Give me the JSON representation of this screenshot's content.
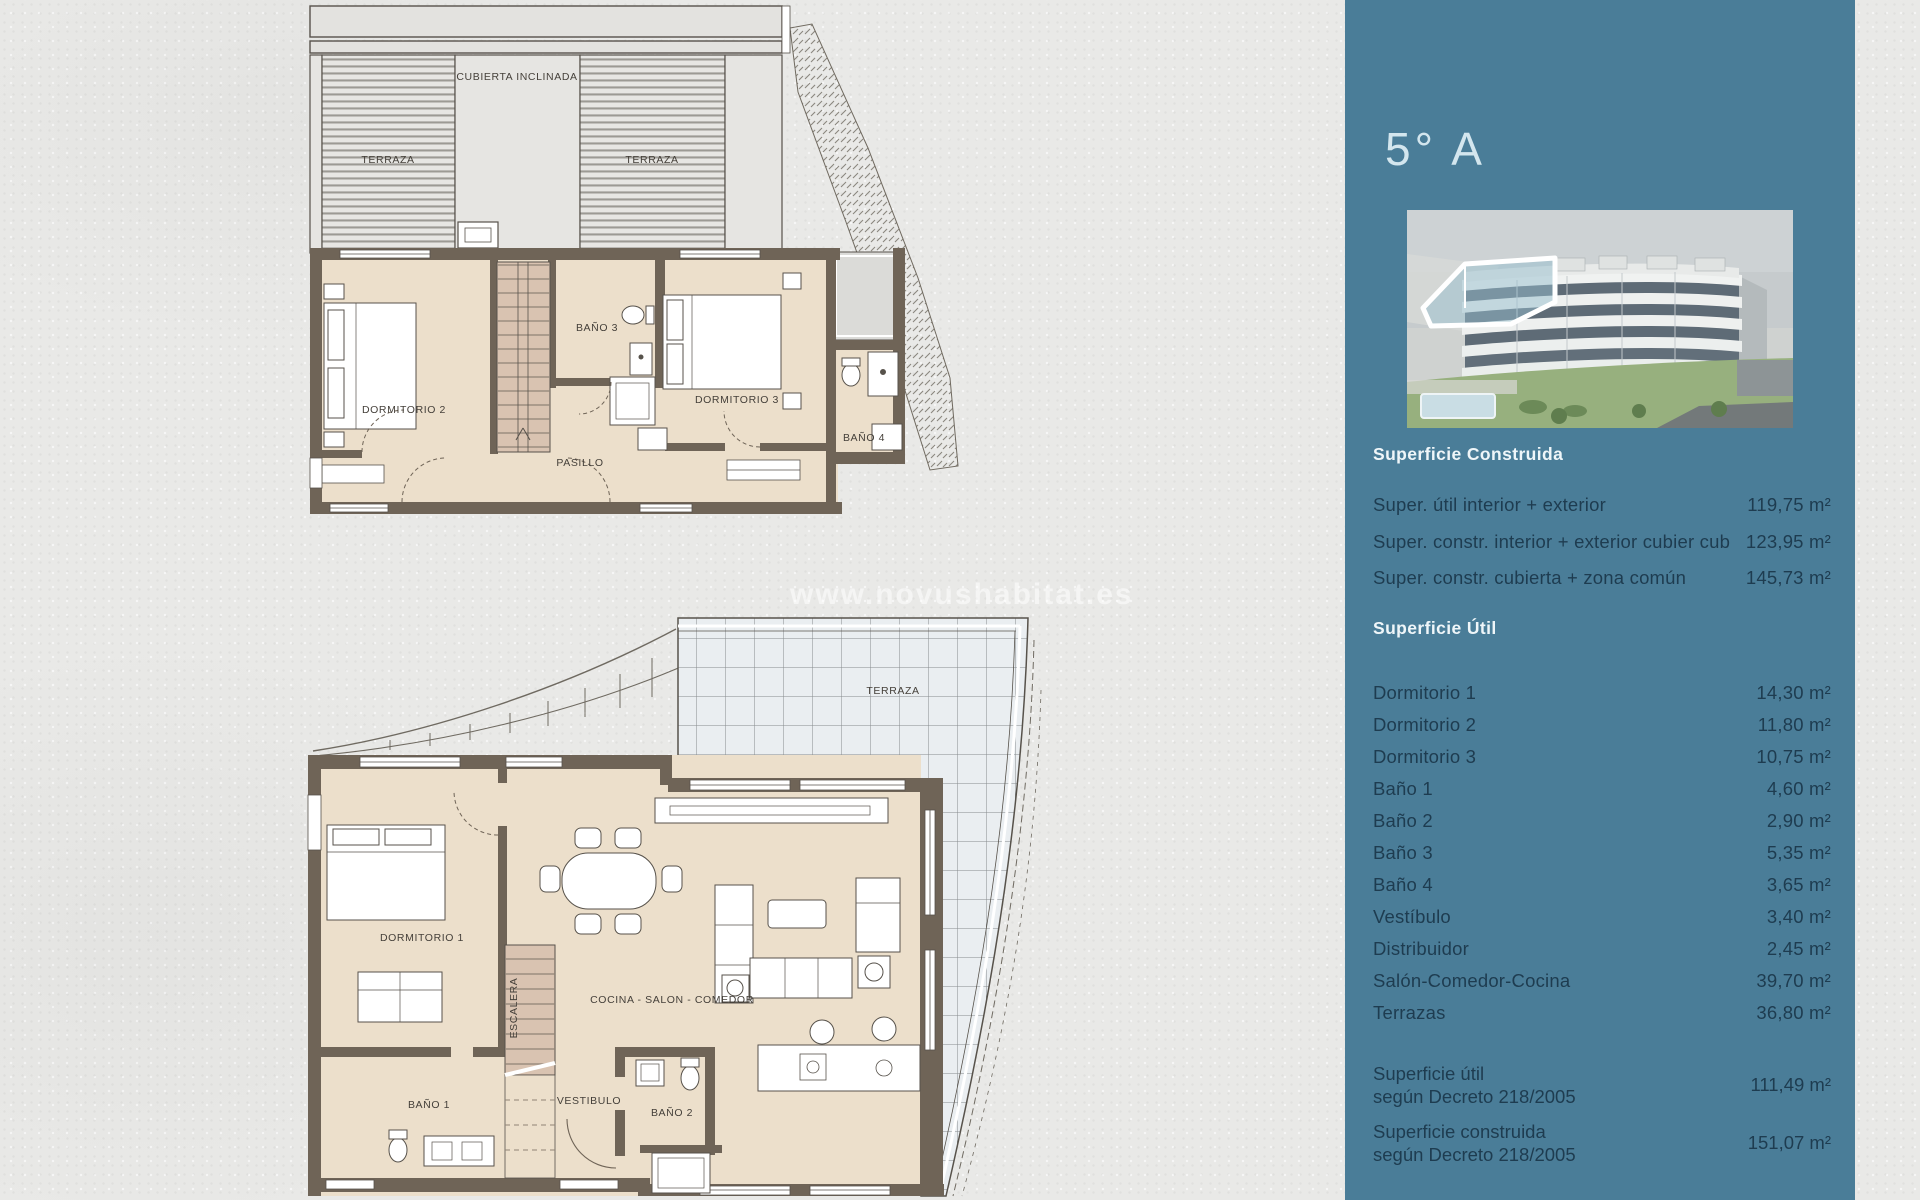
{
  "page": {
    "watermark": "www.novushabitat.es",
    "background_color": "#e9e9e7"
  },
  "sidebar": {
    "background_color": "#4a7d98",
    "unit_title": "5° A",
    "building_image": "aerial-render-apartment-building-unit-5A-highlighted",
    "superficie_construida": {
      "heading": "Superficie Construida",
      "rows": [
        {
          "label": "Super. útil interior + exterior",
          "value": "119,75 m²"
        },
        {
          "label": "Super. constr. interior + exterior cubier cub",
          "value": "123,95 m²"
        },
        {
          "label": "Super. constr. cubierta + zona común",
          "value": "145,73 m²"
        }
      ]
    },
    "superficie_util": {
      "heading": "Superficie Útil",
      "rows": [
        {
          "label": "Dormitorio 1",
          "value": "14,30 m²"
        },
        {
          "label": "Dormitorio 2",
          "value": "11,80 m²"
        },
        {
          "label": "Dormitorio 3",
          "value": "10,75 m²"
        },
        {
          "label": "Baño 1",
          "value": "4,60 m²"
        },
        {
          "label": "Baño 2",
          "value": "2,90 m²"
        },
        {
          "label": "Baño 3",
          "value": "5,35 m²"
        },
        {
          "label": "Baño 4",
          "value": "3,65 m²"
        },
        {
          "label": "Vestíbulo",
          "value": "3,40 m²"
        },
        {
          "label": "Distribuidor",
          "value": "2,45 m²"
        },
        {
          "label": "Salón-Comedor-Cocina",
          "value": "39,70 m²"
        },
        {
          "label": "Terrazas",
          "value": "36,80 m²"
        }
      ]
    },
    "decreto": {
      "rows": [
        {
          "line1": "Superficie útil",
          "line2": "según Decreto 218/2005",
          "value": "111,49 m²"
        },
        {
          "line1": "Superficie construida",
          "line2": "según Decreto 218/2005",
          "value": "151,07 m²"
        }
      ]
    }
  },
  "plans": {
    "upper": {
      "labels": {
        "terraza_left": "TERRAZA",
        "cubierta": "CUBIERTA INCLINADA",
        "terraza_right": "TERRAZA",
        "dormitorio2": "DORMITORIO 2",
        "bano3": "BAÑO 3",
        "dormitorio3": "DORMITORIO 3",
        "bano4": "BAÑO 4",
        "pasillo": "PASILLO"
      }
    },
    "lower": {
      "labels": {
        "terraza": "TERRAZA",
        "dormitorio1": "DORMITORIO 1",
        "cocina_salon_comedor": "COCINA - SALON - COMEDOR",
        "escalera": "ESCALERA",
        "bano1": "BAÑO 1",
        "vestibulo": "VESTIBULO",
        "bano2": "BAÑO 2"
      }
    }
  }
}
